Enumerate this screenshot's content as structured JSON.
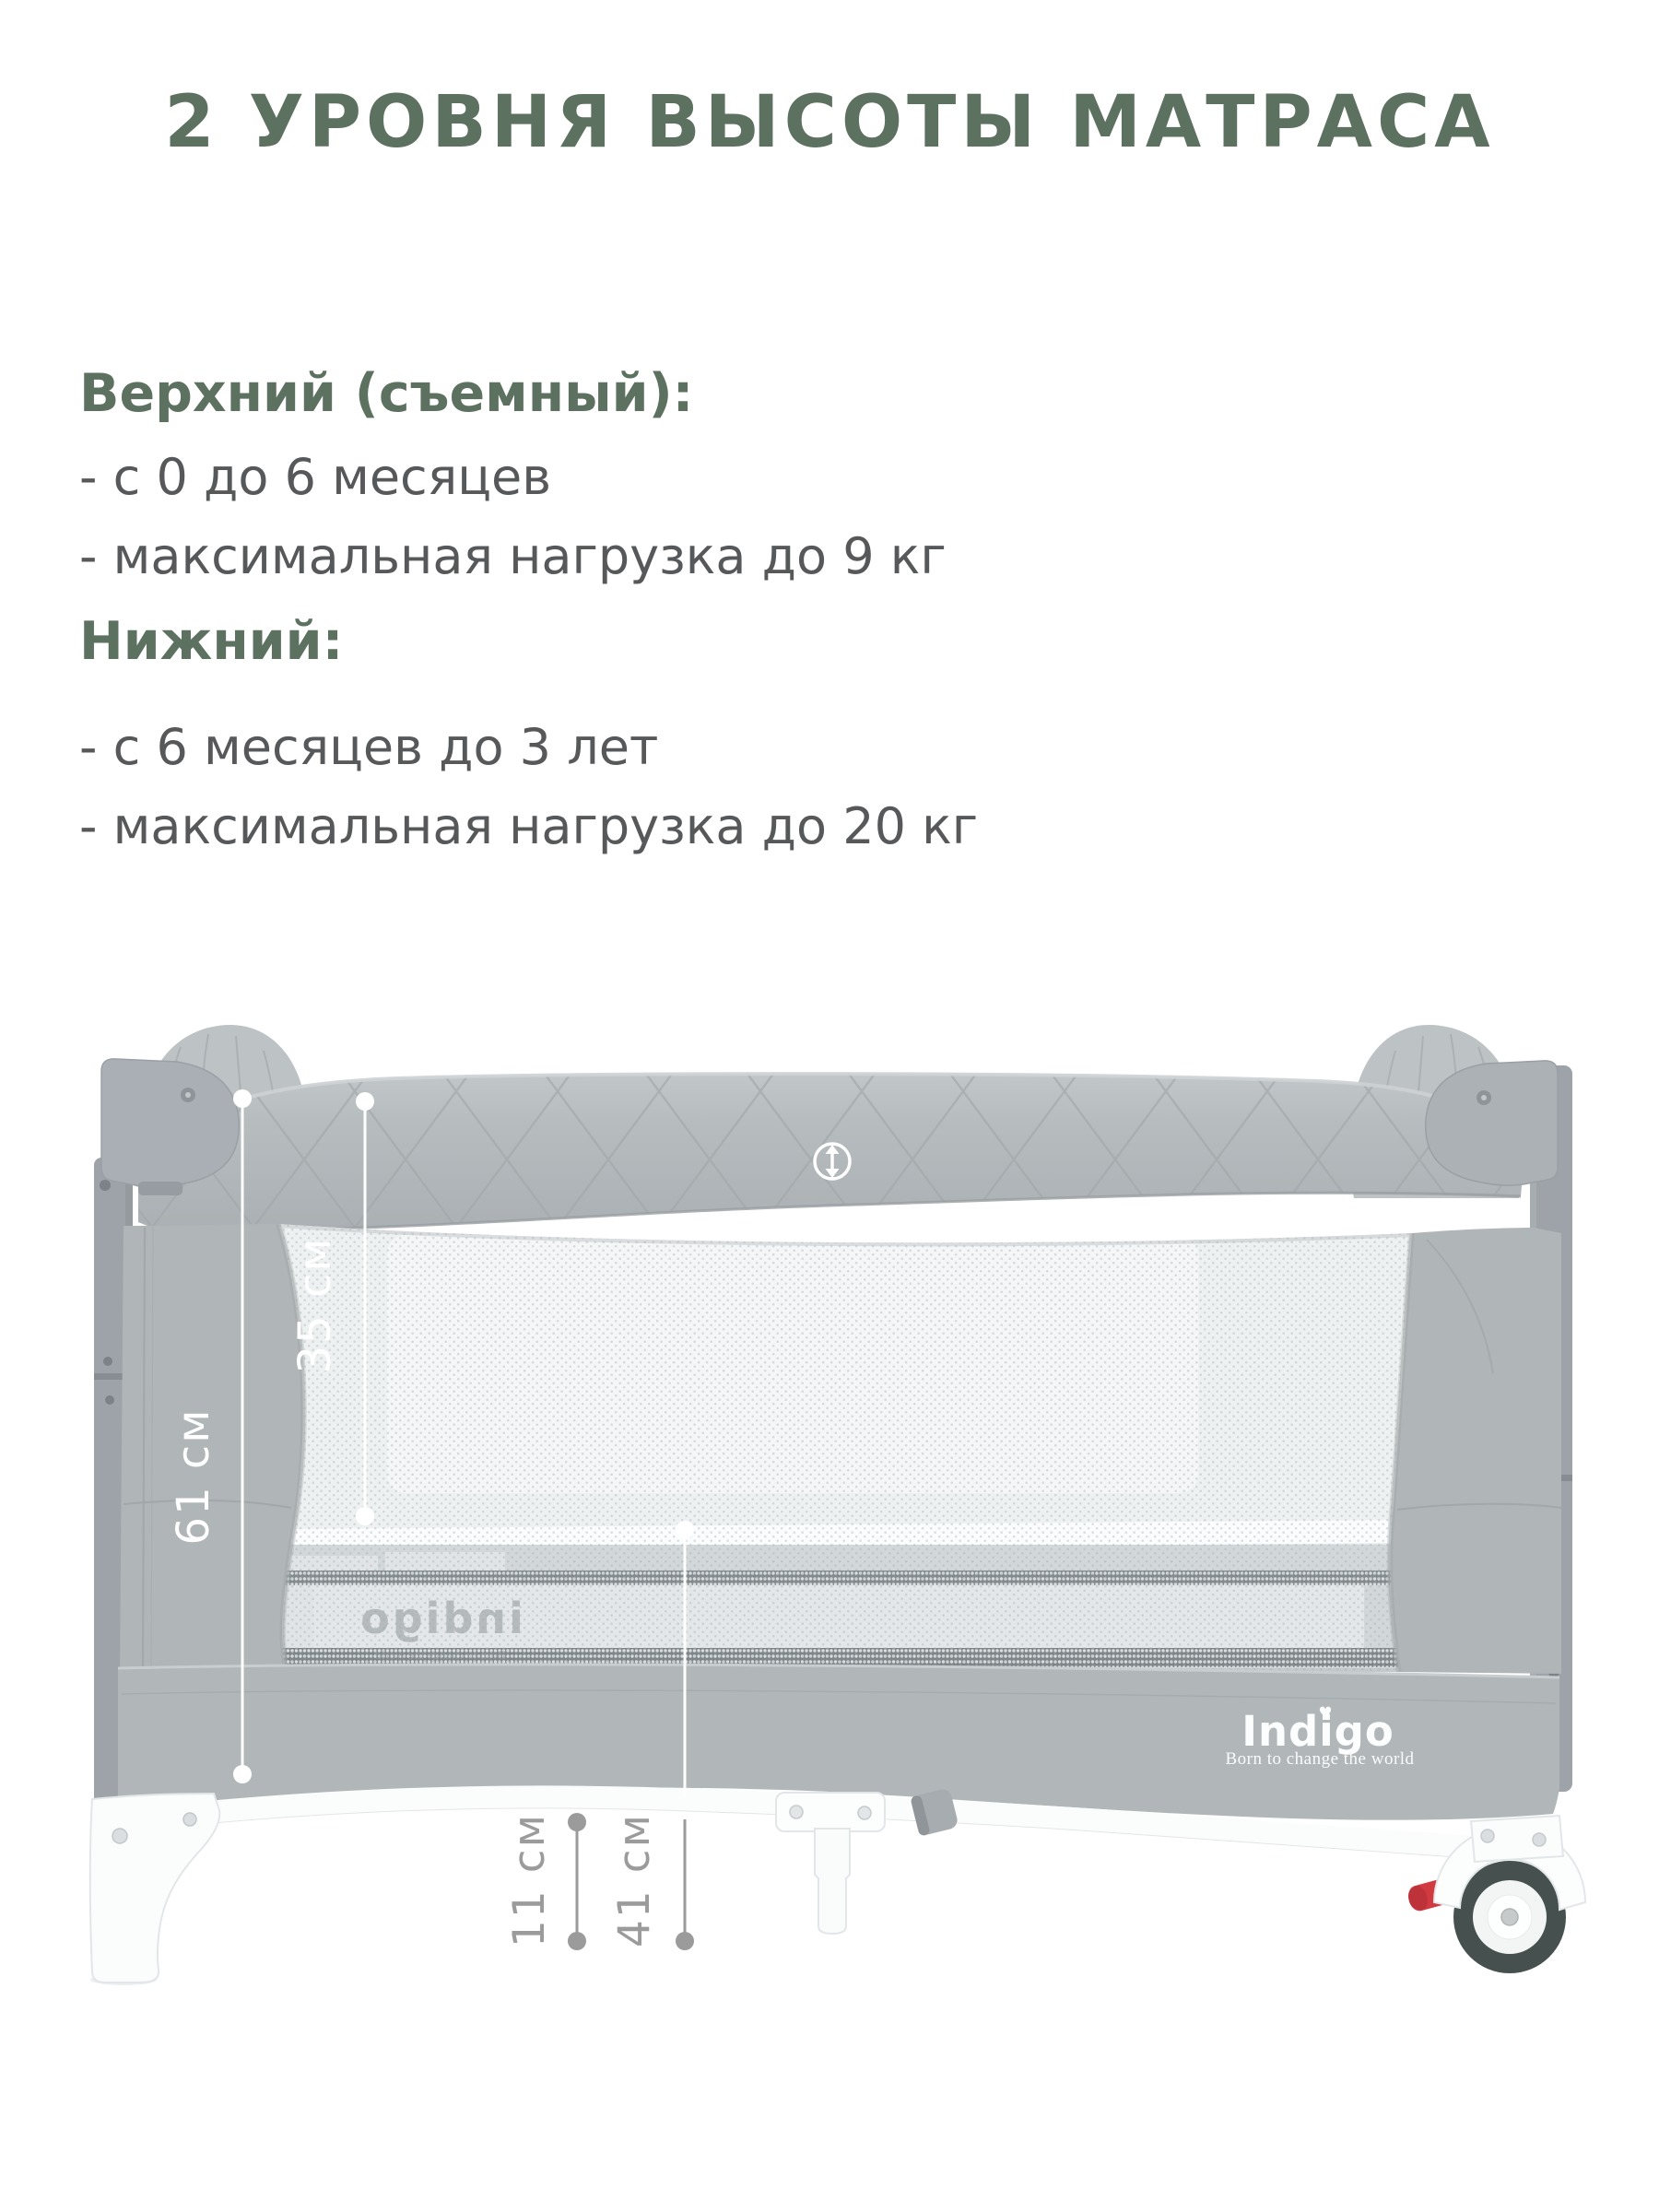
{
  "title": "2 УРОВНЯ ВЫСОТЫ МАТРАСА",
  "sections": [
    {
      "heading": "Верхний (съемный):",
      "items": [
        "- с 0 до 6 месяцев",
        "- максимальная нагрузка до 9 кг"
      ]
    },
    {
      "heading": "Нижний:",
      "items": [
        "- с 6 месяцев до 3 лет",
        "- максимальная нагрузка до 20 кг"
      ]
    }
  ],
  "measurements": {
    "side_full_height": "61 см",
    "top_to_upper_mattress": "35 см",
    "floor_to_frame": "11 см",
    "floor_to_upper_mattress": "41 см"
  },
  "brand": {
    "name": "Indigo",
    "tagline": "Born to change the world",
    "mattress_watermark": "indigo"
  },
  "icons": {
    "height_adjust": "↕",
    "heart_dot": "♥"
  },
  "colors": {
    "accent_green": "#5d7160",
    "text_gray": "#57585a",
    "fabric_gray": "#b5bbbd",
    "measure_white": "#ffffff",
    "measure_gray": "#9b9b9b",
    "wheel_red": "#d03a40"
  }
}
